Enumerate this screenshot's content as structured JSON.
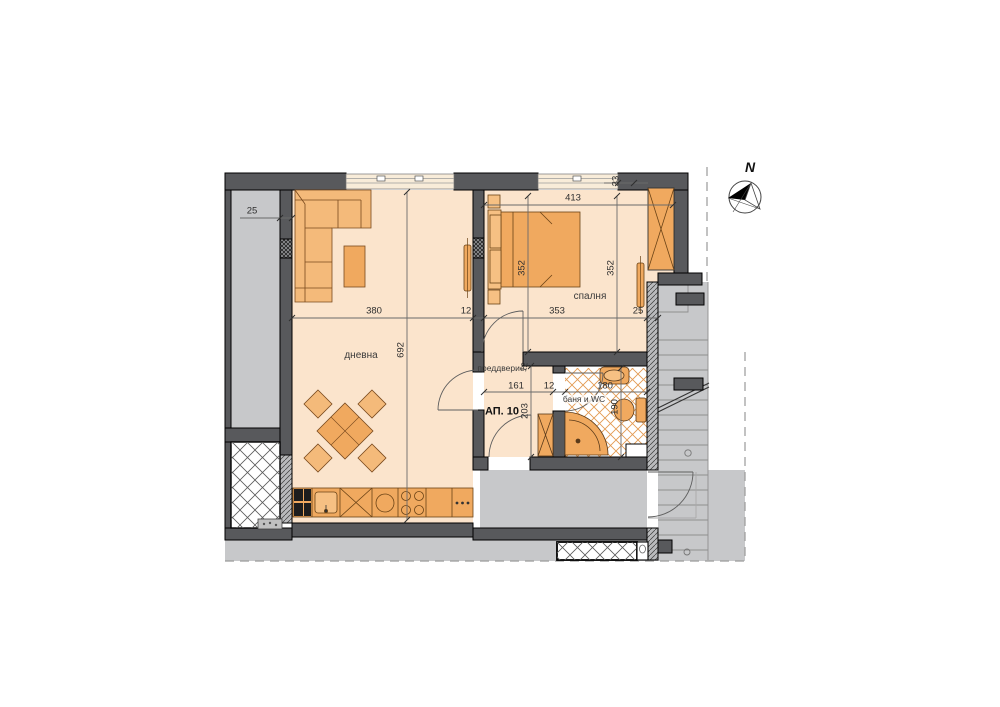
{
  "title": "Apartment floor plan",
  "compass": {
    "north_label": "N"
  },
  "apartment": {
    "number_label": "АП. 10"
  },
  "rooms": {
    "living": "дневна",
    "bedroom": "спалня",
    "vestibule": "преддверие",
    "bathroom": "баня и WC"
  },
  "dimensions": {
    "wall_left": "25",
    "living_width": "380",
    "partition": "12",
    "bedroom_width": "353",
    "wall_right": "25",
    "bedroom_top_width": "413",
    "corner_offset": "33",
    "bed_depth": "352",
    "bedroom_depth": "352",
    "living_depth": "692",
    "vestibule_width": "161",
    "bath_wall": "12",
    "bathroom_width": "180",
    "vestibule_depth": "203",
    "bathroom_depth": "190",
    "partition_thickness": "12"
  },
  "colors": {
    "wall": "#58595c",
    "floor": "#fbe4cc",
    "furniture": "#f0a95f",
    "furniture_light": "#f6c083",
    "common_area": "#c7c8ca",
    "bath_tile": "#e29a52"
  }
}
